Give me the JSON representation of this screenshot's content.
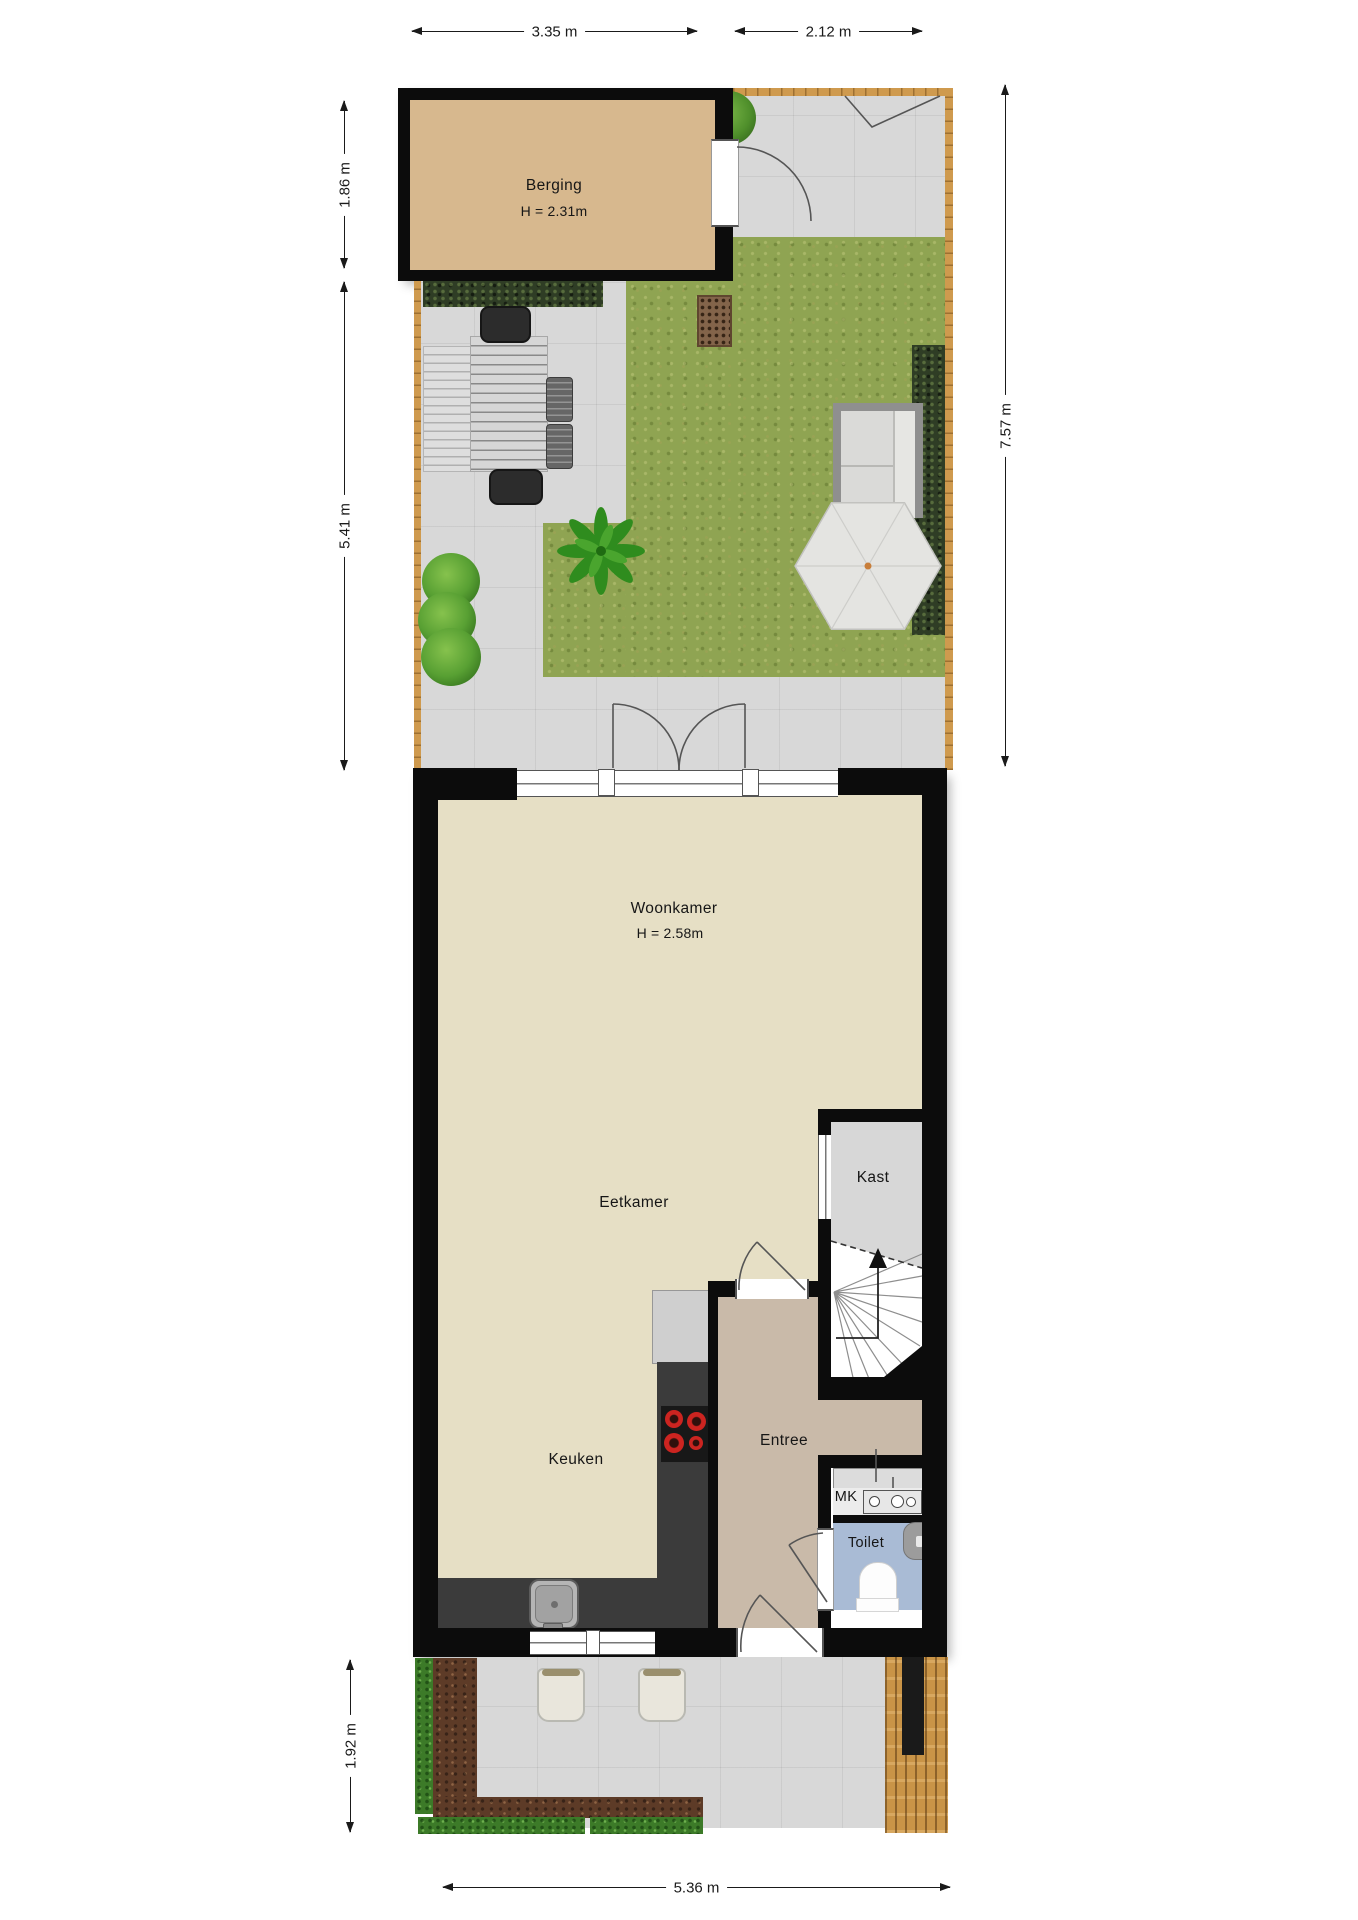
{
  "dimensions": {
    "top_left": "3.35 m",
    "top_right": "2.12 m",
    "left_upper": "1.86 m",
    "left_lower": "5.41 m",
    "right_side": "7.57 m",
    "bottom_left": "1.92 m",
    "bottom": "5.36 m"
  },
  "rooms": {
    "berging": {
      "name": "Berging",
      "ceiling_height": "H = 2.31m"
    },
    "woonkamer": {
      "name": "Woonkamer",
      "ceiling_height": "H = 2.58m"
    },
    "eetkamer": {
      "name": "Eetkamer"
    },
    "keuken": {
      "name": "Keuken"
    },
    "entree": {
      "name": "Entree"
    },
    "kast": {
      "name": "Kast"
    },
    "mk": {
      "name": "MK"
    },
    "toilet": {
      "name": "Toilet"
    }
  },
  "colors": {
    "wall": "#0c0c0c",
    "berging-floor": "#d7b88e",
    "living-floor": "#e6dfc5",
    "entree-floor": "#c9baa9",
    "kast-floor": "#d7d7d7",
    "toilet-floor": "#a9bbd5",
    "grass": "#8fa452",
    "patio": "#d8d8d8",
    "hedge-dark": "#2f3d25",
    "hedge-bright": "#3c7a28",
    "soil": "#5d3b27",
    "wood": "#cf9a4e",
    "counter": "#3b3b3b",
    "burner-red": "#cc2420",
    "dim-line": "#1a1a1a"
  }
}
